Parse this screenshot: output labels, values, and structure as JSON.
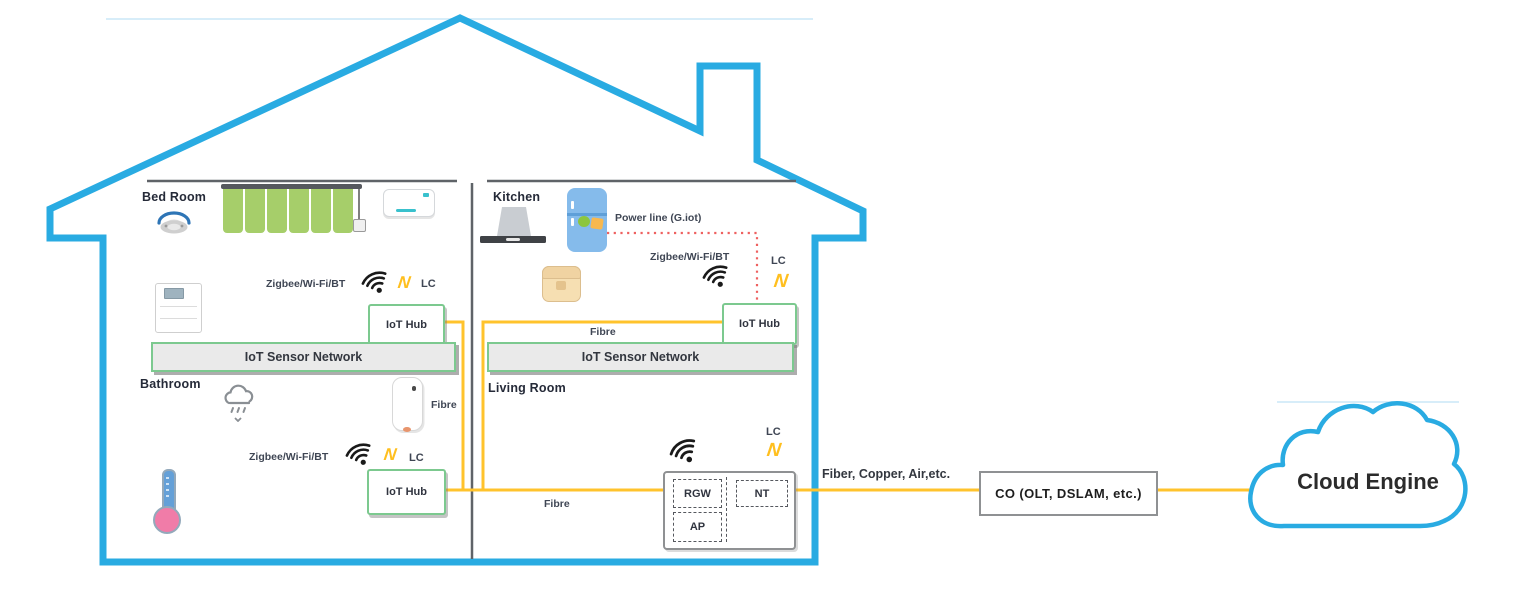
{
  "icons": {
    "lightning_glyph": "N",
    "wifi": "signal-arcs",
    "smoke_detector": "ceiling-dome",
    "curtain": "green-panels-on-rail",
    "air_conditioner": "wall-unit",
    "air_purifier": "floor-unit",
    "range_hood": "kitchen-hood",
    "fridge": "blue-refrigerator",
    "rice_cooker": "countertop-cooker",
    "shower": "shower-cloud",
    "water_heater": "wall-boiler",
    "thermometer": "bulb-thermometer",
    "cloud": "cloud-outline"
  },
  "colors": {
    "house-blue": "#29ABE2",
    "fibre-yellow": "#FFC32C",
    "hub-green": "#7CC98F",
    "powerline-red": "#EE6160",
    "curtain-green": "#A6CE6A",
    "fridge-blue": "#85BBEB",
    "bolt-yellow": "#FFBF1F",
    "wall-gray": "#5F6368",
    "text-dark": "#2A2F3C"
  },
  "house": {
    "bedroom": {
      "name": "Bed Room",
      "protocols": "Zigbee/Wi-Fi/BT",
      "lc": "LC",
      "hub": "IoT Hub",
      "sensor_network": "IoT Sensor Network"
    },
    "kitchen": {
      "name": "Kitchen",
      "powerline": "Power line (G.iot)",
      "protocols": "Zigbee/Wi-Fi/BT",
      "lc": "LC",
      "hub": "IoT Hub",
      "fibre": "Fibre",
      "sensor_network": "IoT Sensor Network"
    },
    "bathroom": {
      "name": "Bathroom",
      "protocols": "Zigbee/Wi-Fi/BT",
      "lc": "LC",
      "hub": "IoT Hub",
      "fibre": "Fibre"
    },
    "living_room": {
      "name": "Living Room",
      "lc": "LC",
      "fibre": "Fibre",
      "rgw": "RGW",
      "nt": "NT",
      "ap": "AP"
    }
  },
  "wan": {
    "access_link": "Fiber, Copper, Air,etc.",
    "central_office": "CO (OLT, DSLAM, etc.)",
    "cloud": "Cloud Engine"
  }
}
